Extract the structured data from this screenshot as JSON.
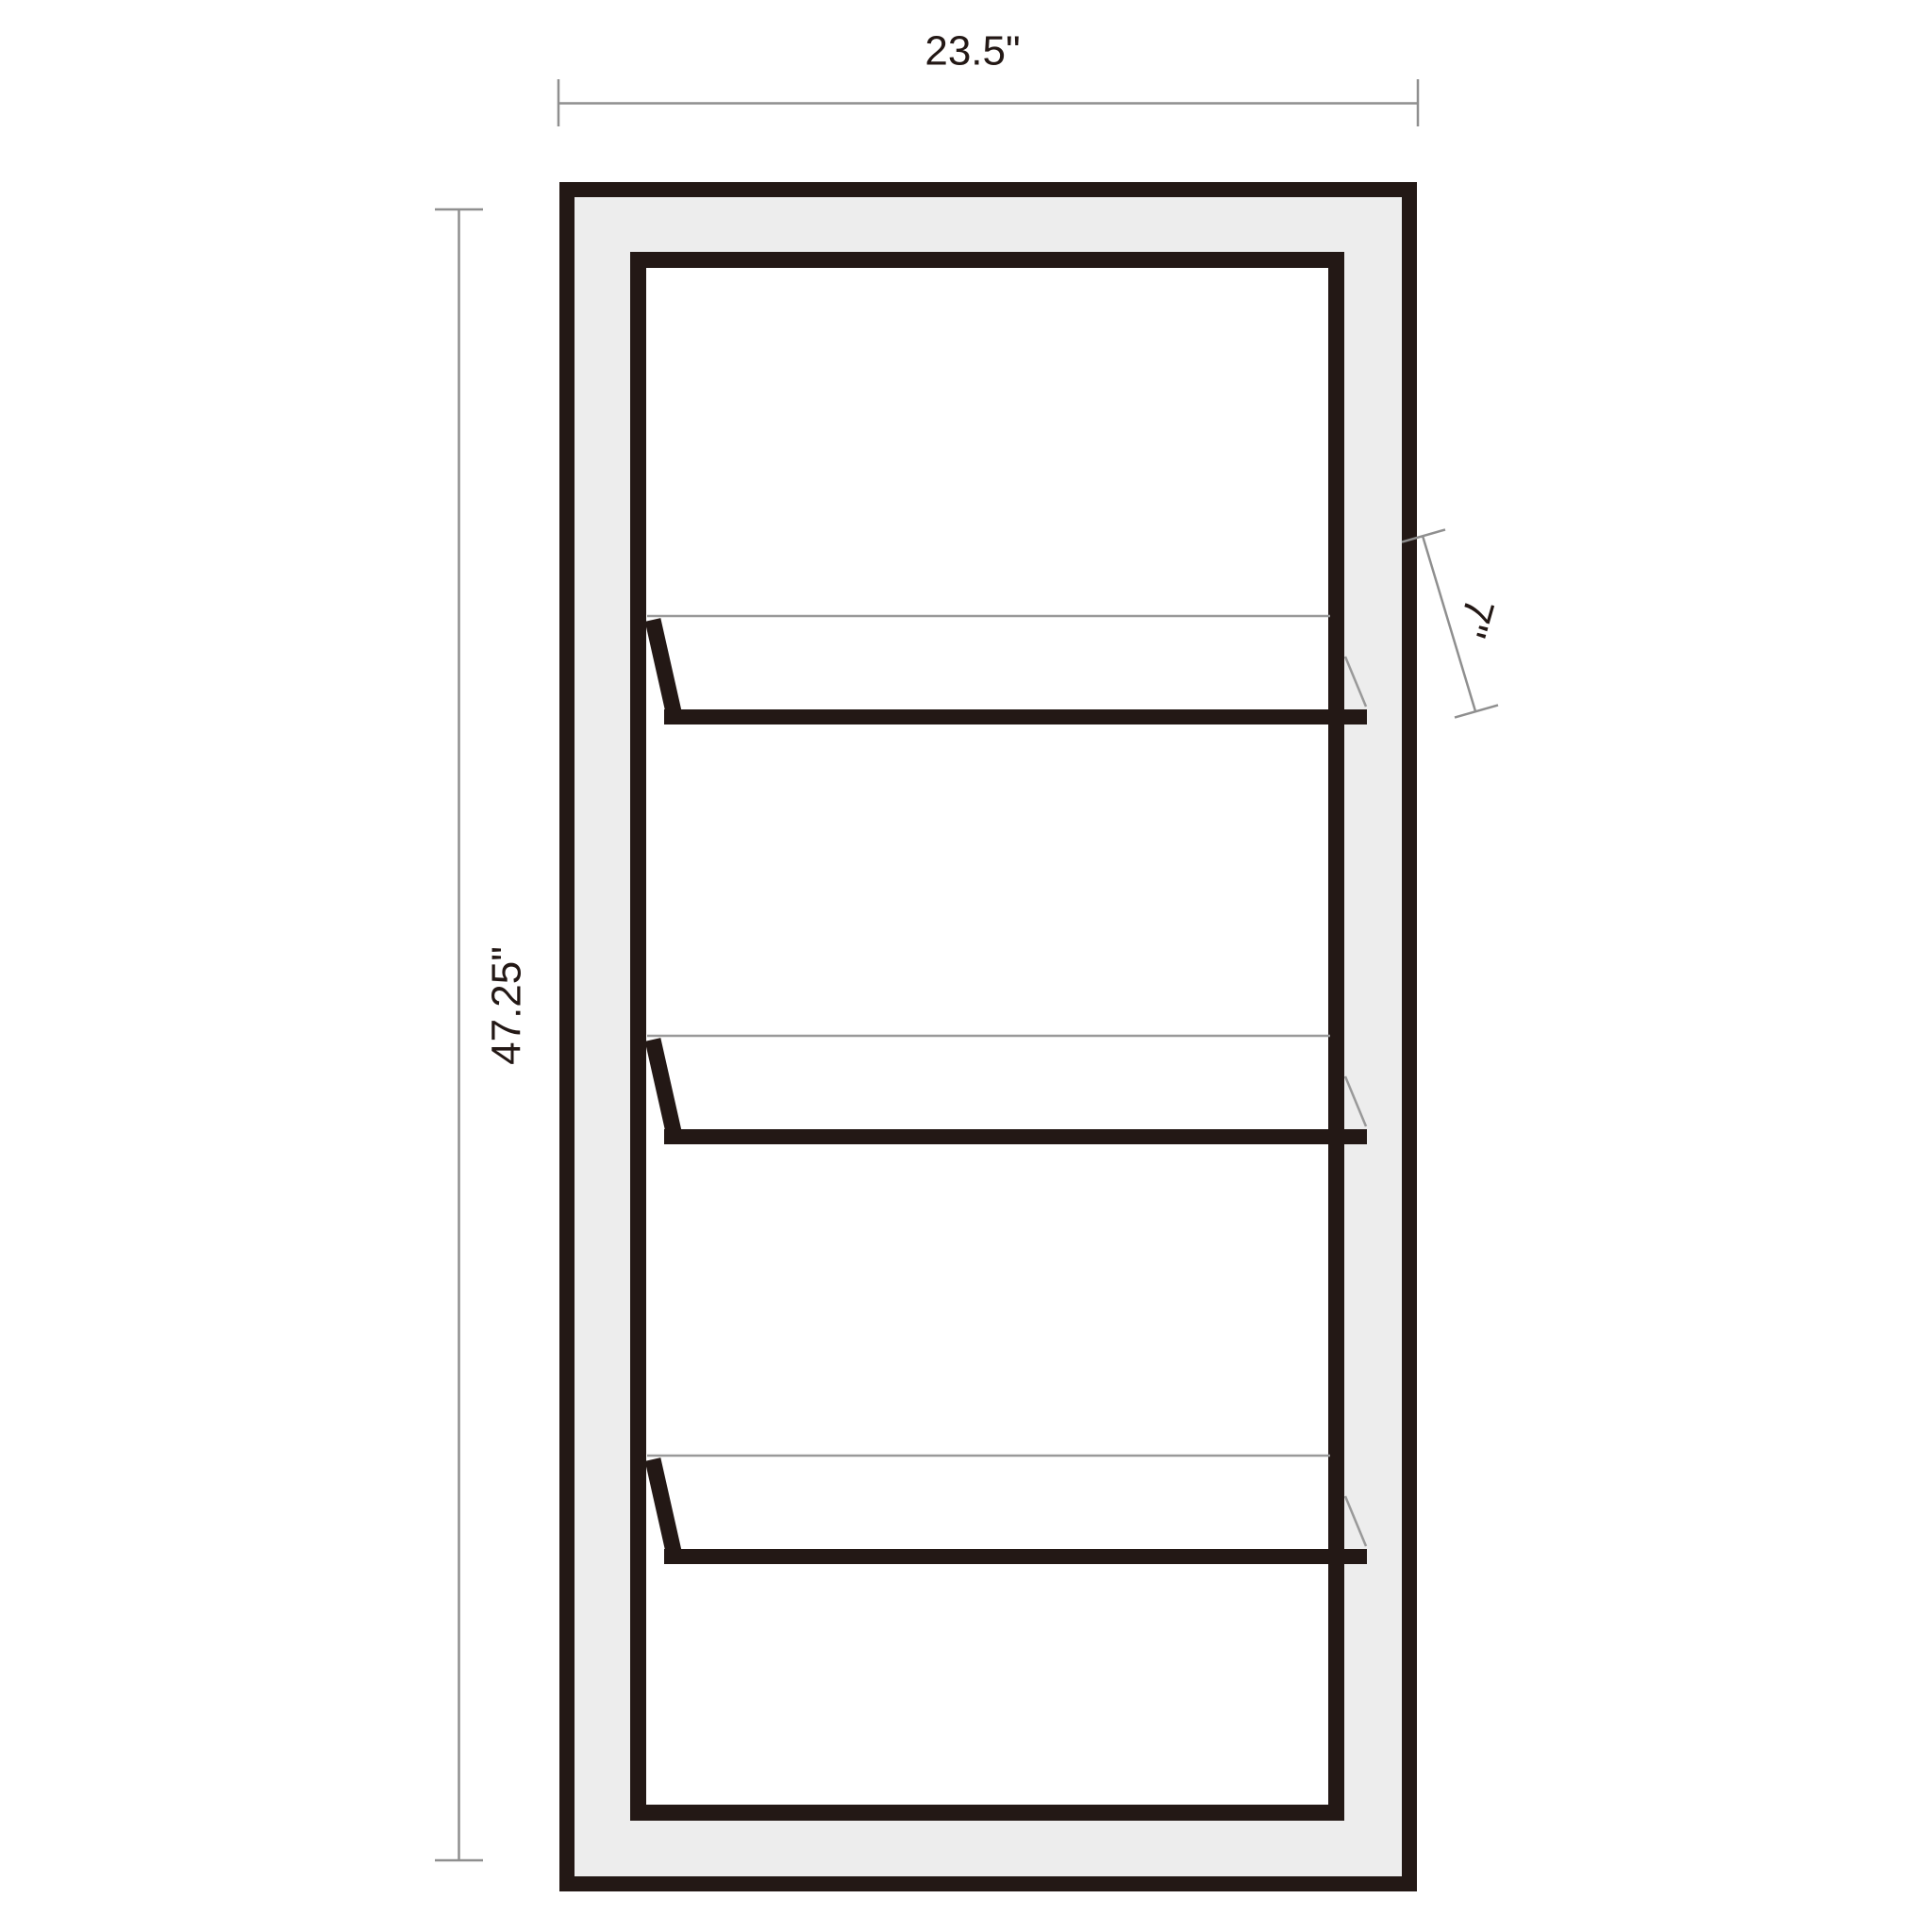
{
  "diagram": {
    "object": "open cabinet with three shelves, front elevation dimension drawing",
    "shelf_count": 3,
    "dimensions": {
      "width": {
        "label": "23.5\""
      },
      "height": {
        "label": "47.25\""
      },
      "shelf_depth": {
        "label": "7\""
      }
    },
    "colors": {
      "frame": "#231815",
      "panel": "#ededed",
      "interior": "#ffffff",
      "dim": "#8f8f8f",
      "shelfline": "#999999",
      "text": "#231815",
      "background": "#ffffff"
    }
  }
}
